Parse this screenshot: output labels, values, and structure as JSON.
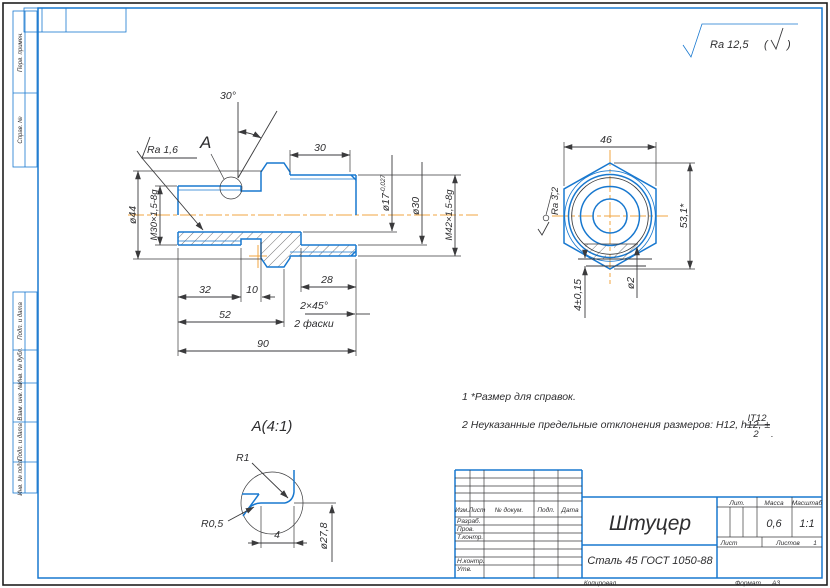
{
  "sheet": {
    "general_roughness": "Ra 12,5",
    "paren_open": "(",
    "paren_close": ")",
    "copied_label": "Копировал",
    "format_label": "Формат",
    "format_value": "A3"
  },
  "margins": {
    "labels": [
      "Перв. примен.",
      "Справ. №",
      "Подп. и дата",
      "Инв. № дубл.",
      "Взам. инв. №",
      "Подп. и дата",
      "Инв. № подл."
    ]
  },
  "main_view": {
    "label_a": "A",
    "angle_30": "30°",
    "ra_16": "Ra 1,6",
    "dim_30": "30",
    "dia_44": "ø44",
    "thread_m30": "M30×1,5-8g",
    "dia_17": "ø17",
    "dia_17_tol": "-0,027",
    "dia_30": "ø30",
    "thread_m42": "M42×1,5-8g",
    "dim_32": "32",
    "dim_10": "10",
    "dim_28": "28",
    "dim_52": "52",
    "chamfer": "2×45°",
    "chamfer_qty": "2 фаски",
    "dim_90": "90"
  },
  "side_view": {
    "dim_46": "46",
    "dim_53": "53,1*",
    "ra_32": "Ra 3,2",
    "dia_2": "ø2",
    "dim_4": "4±0,15"
  },
  "detail_a": {
    "title": "A(4:1)",
    "r1": "R1",
    "r05": "R0,5",
    "dim_4": "4",
    "dia_278": "ø27,8"
  },
  "notes": {
    "line1": "1 *Размер для справок.",
    "line2": "2 Неуказанные предельные отклонения размеров: H12, h12, ±",
    "frac_num": "IT12",
    "frac_den": "2",
    "line2_end": "."
  },
  "title_block": {
    "name": "Штуцер",
    "material": "Сталь 45  ГОСТ 1050-88",
    "col_izm": "Изм.",
    "col_list": "Лист",
    "col_doc": "№ докум.",
    "col_sign": "Подп.",
    "col_date": "Дата",
    "row_razrab": "Разраб.",
    "row_prov": "Пров.",
    "row_tkontr": "Т.контр.",
    "row_nkontr": "Н.контр.",
    "row_utv": "Утв.",
    "lit_label": "Лит.",
    "mass_label": "Масса",
    "scale_label": "Масштаб",
    "mass_value": "0,6",
    "scale_value": "1:1",
    "sheet_label": "Лист",
    "sheets_label": "Листов",
    "sheets_value": "1"
  }
}
